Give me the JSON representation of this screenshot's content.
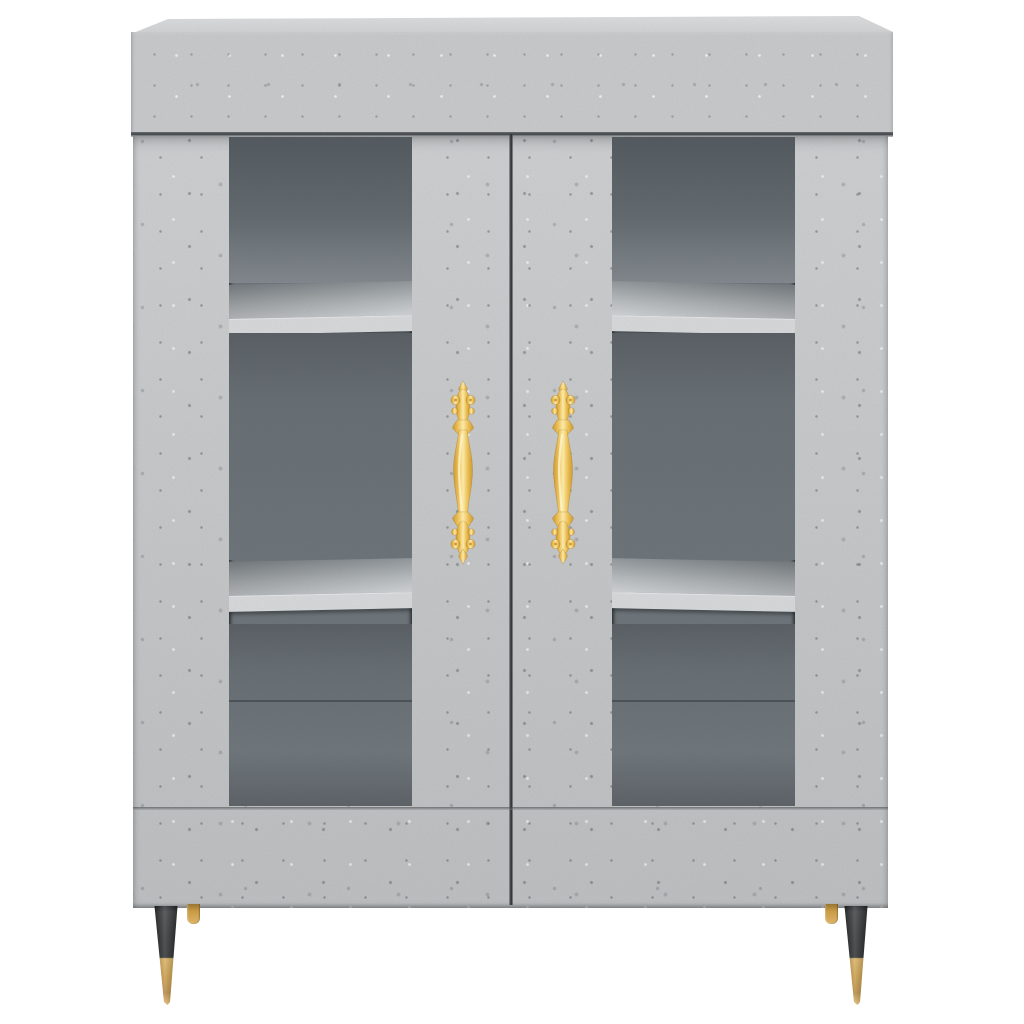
{
  "image_type": "product-photo",
  "subject": {
    "name": "Concrete grey highboard cabinet with two glass doors, gold handles and tapered legs",
    "material_style": "concrete grey wood-effect",
    "background": "plain white",
    "components": {
      "doors": 2,
      "glass_panels": 2,
      "shelves_visible_per_door": 2,
      "handles": 2,
      "handle_style": "ornate vertical baroque pull, gold",
      "legs": 4,
      "front_leg_style": "tapered cone, black upper with gold tip",
      "back_leg_style": "short gold peg"
    }
  },
  "icons": {
    "left_handle": "ornate-handle-icon",
    "right_handle": "ornate-handle-icon"
  },
  "colors": {
    "background": "#ffffff",
    "concrete": "#c7c9cb",
    "concrete_light": "#cdd0d2",
    "concrete_top": "#dcdee0",
    "interior": "#6e757a",
    "interior_dark": "#5d6368",
    "shelf": "#d6d8da",
    "seam": "#3f4346",
    "handle_gold": "#f0c75e",
    "handle_gold_light": "#fbe9a9",
    "handle_gold_dark": "#cf9a35",
    "leg_black": "#2c2e30",
    "leg_gold": "#c89a44"
  }
}
